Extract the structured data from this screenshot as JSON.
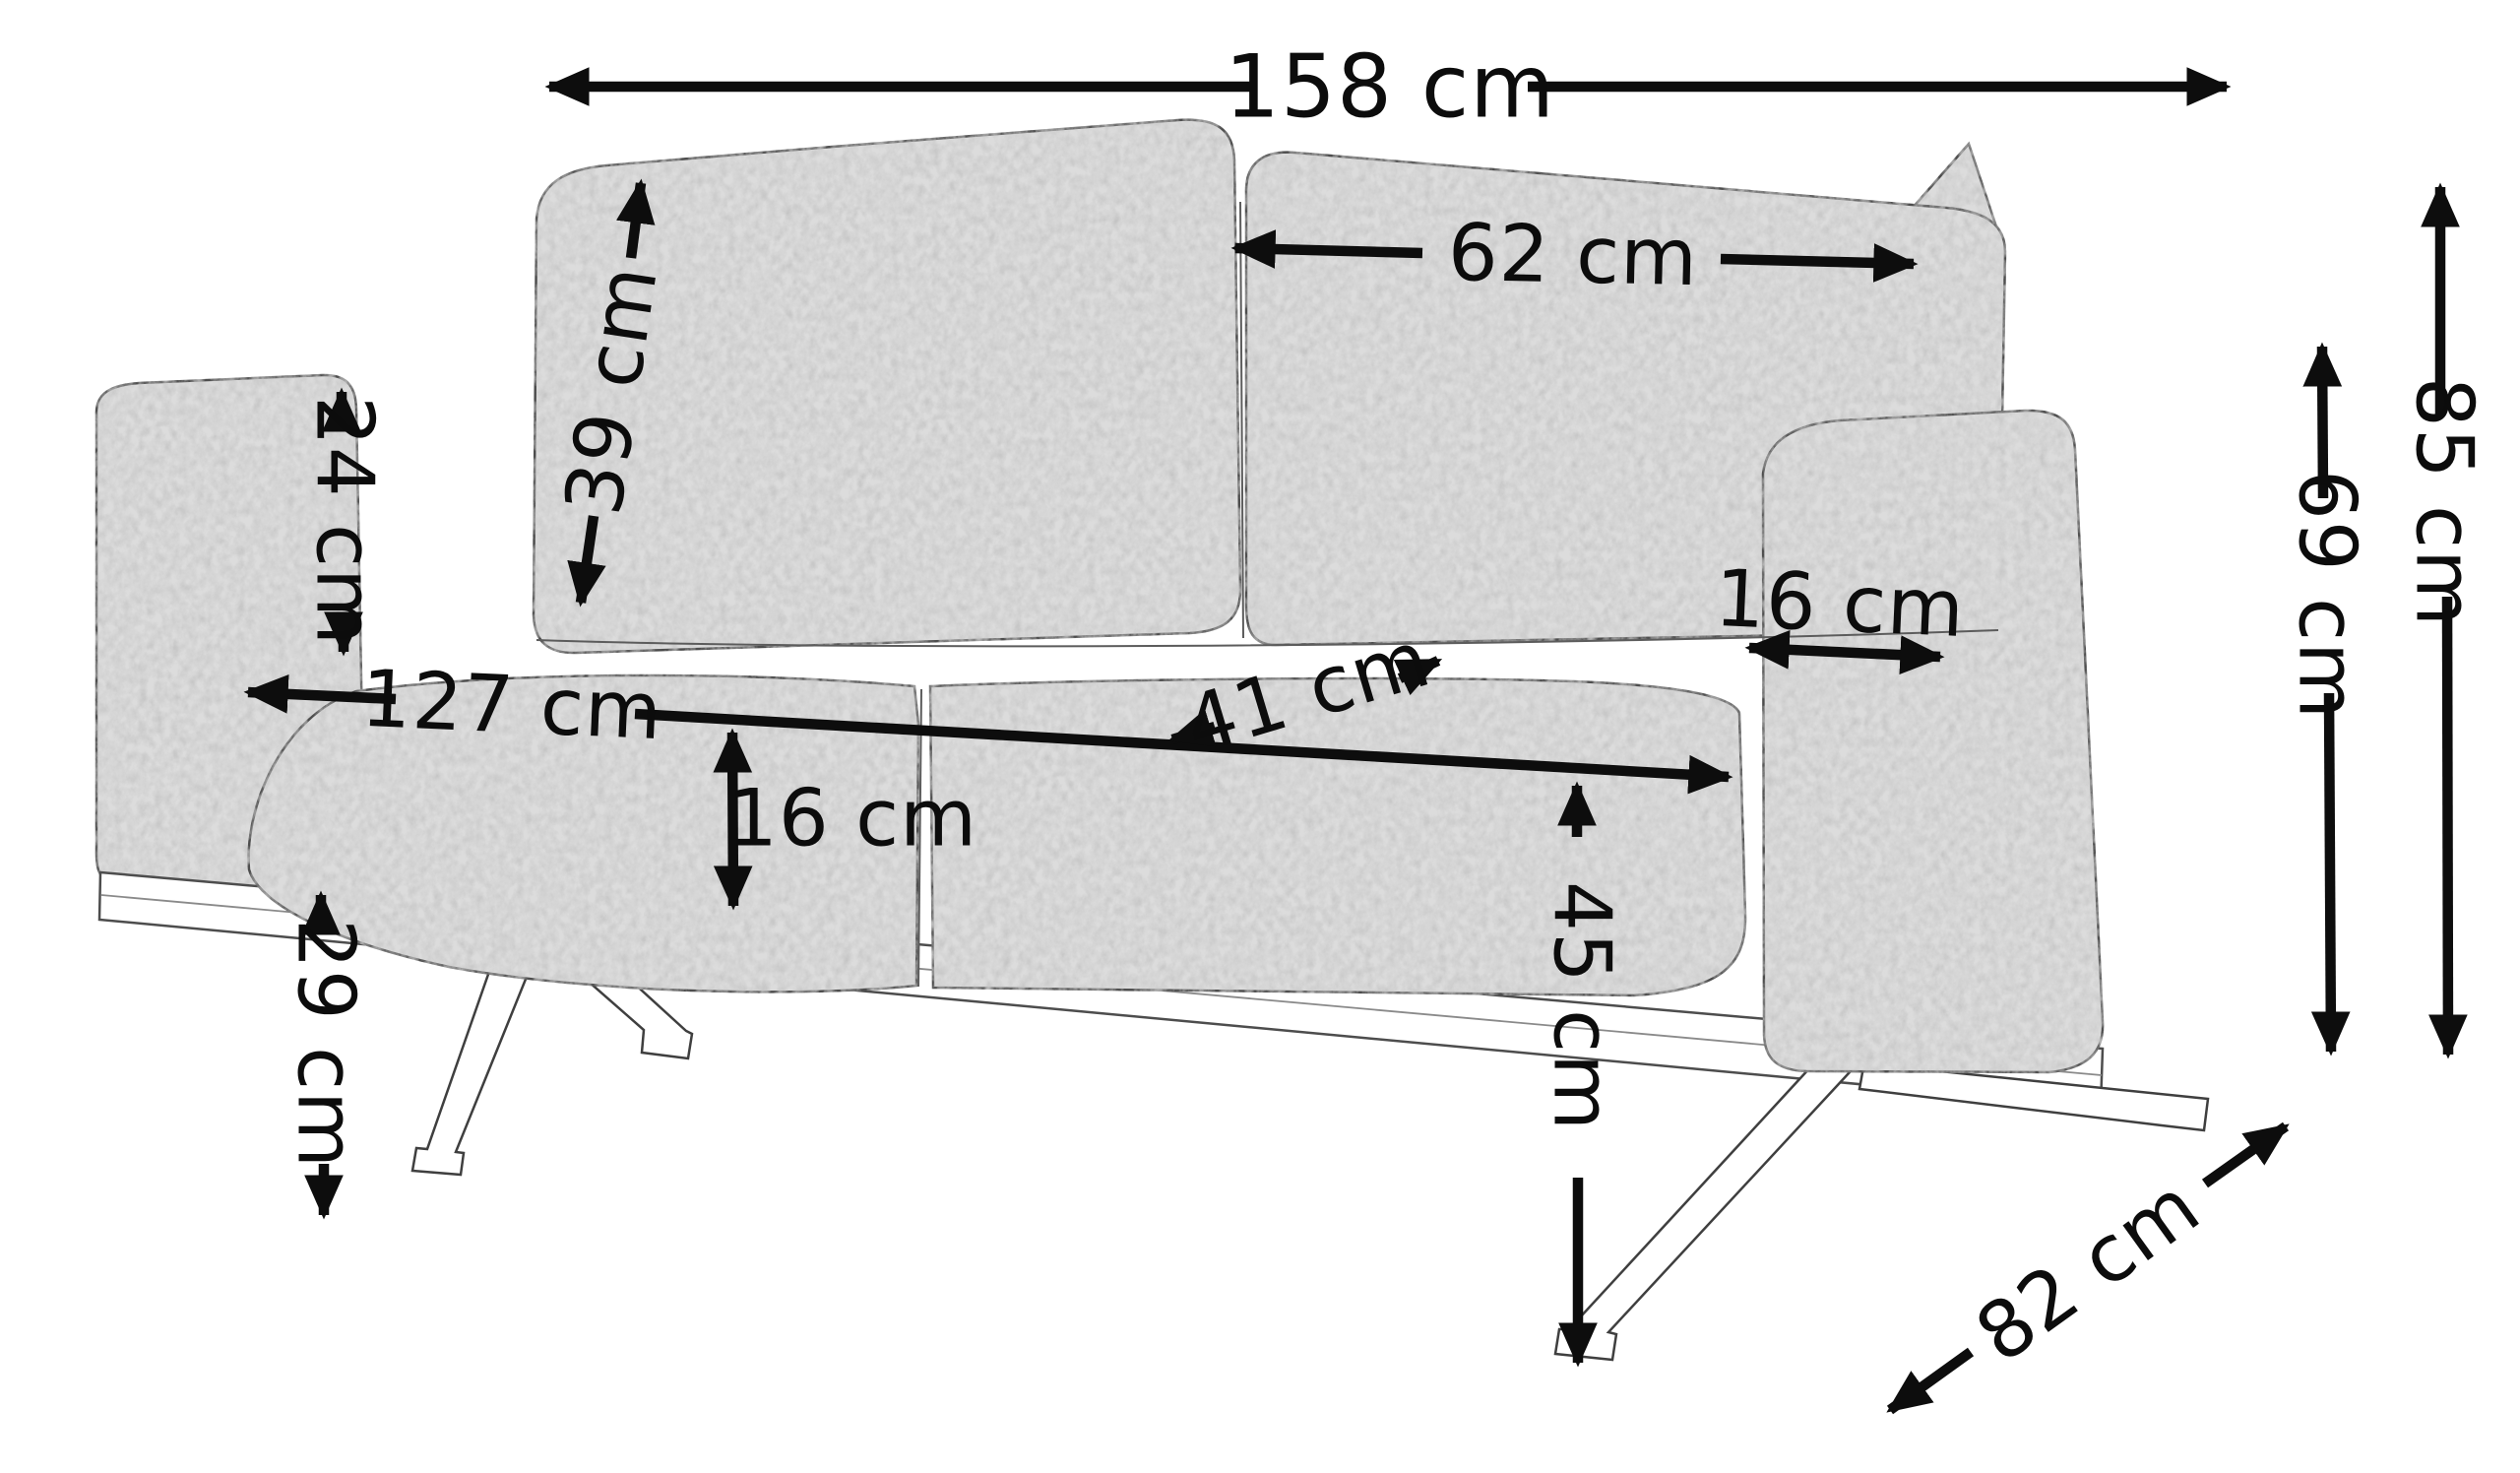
{
  "diagram": {
    "subject": "two-seat sofa dimension drawing",
    "style": "sketch line drawing, grey fabric, splayed metal legs",
    "unit": "cm",
    "colors": {
      "background": "#ffffff",
      "dimension_lines": "#0d0d0d",
      "fabric": "#dcdcdc",
      "fabric_mottle": "#8c8c8c",
      "outline": "#4d4d4d",
      "legs": "#ffffff"
    },
    "dimensions": {
      "total_width": {
        "label": "158 cm",
        "value": 158
      },
      "back_cushion_width": {
        "label": "62 cm",
        "value": 62
      },
      "back_cushion_height": {
        "label": "39 cm",
        "value": 39
      },
      "armrest_height_above_seat": {
        "label": "24 cm",
        "value": 24
      },
      "seat_width": {
        "label": "127 cm",
        "value": 127
      },
      "seat_depth": {
        "label": "41 cm",
        "value": 41
      },
      "armrest_width": {
        "label": "16 cm",
        "value": 16
      },
      "seat_cushion_thickness": {
        "label": "16 cm",
        "value": 16
      },
      "seat_height": {
        "label": "45 cm",
        "value": 45
      },
      "clearance_height": {
        "label": "29 cm",
        "value": 29
      },
      "armrest_top_height": {
        "label": "69 cm",
        "value": 69
      },
      "total_height": {
        "label": "85 cm",
        "value": 85
      },
      "depth": {
        "label": "82 cm",
        "value": 82
      }
    }
  }
}
